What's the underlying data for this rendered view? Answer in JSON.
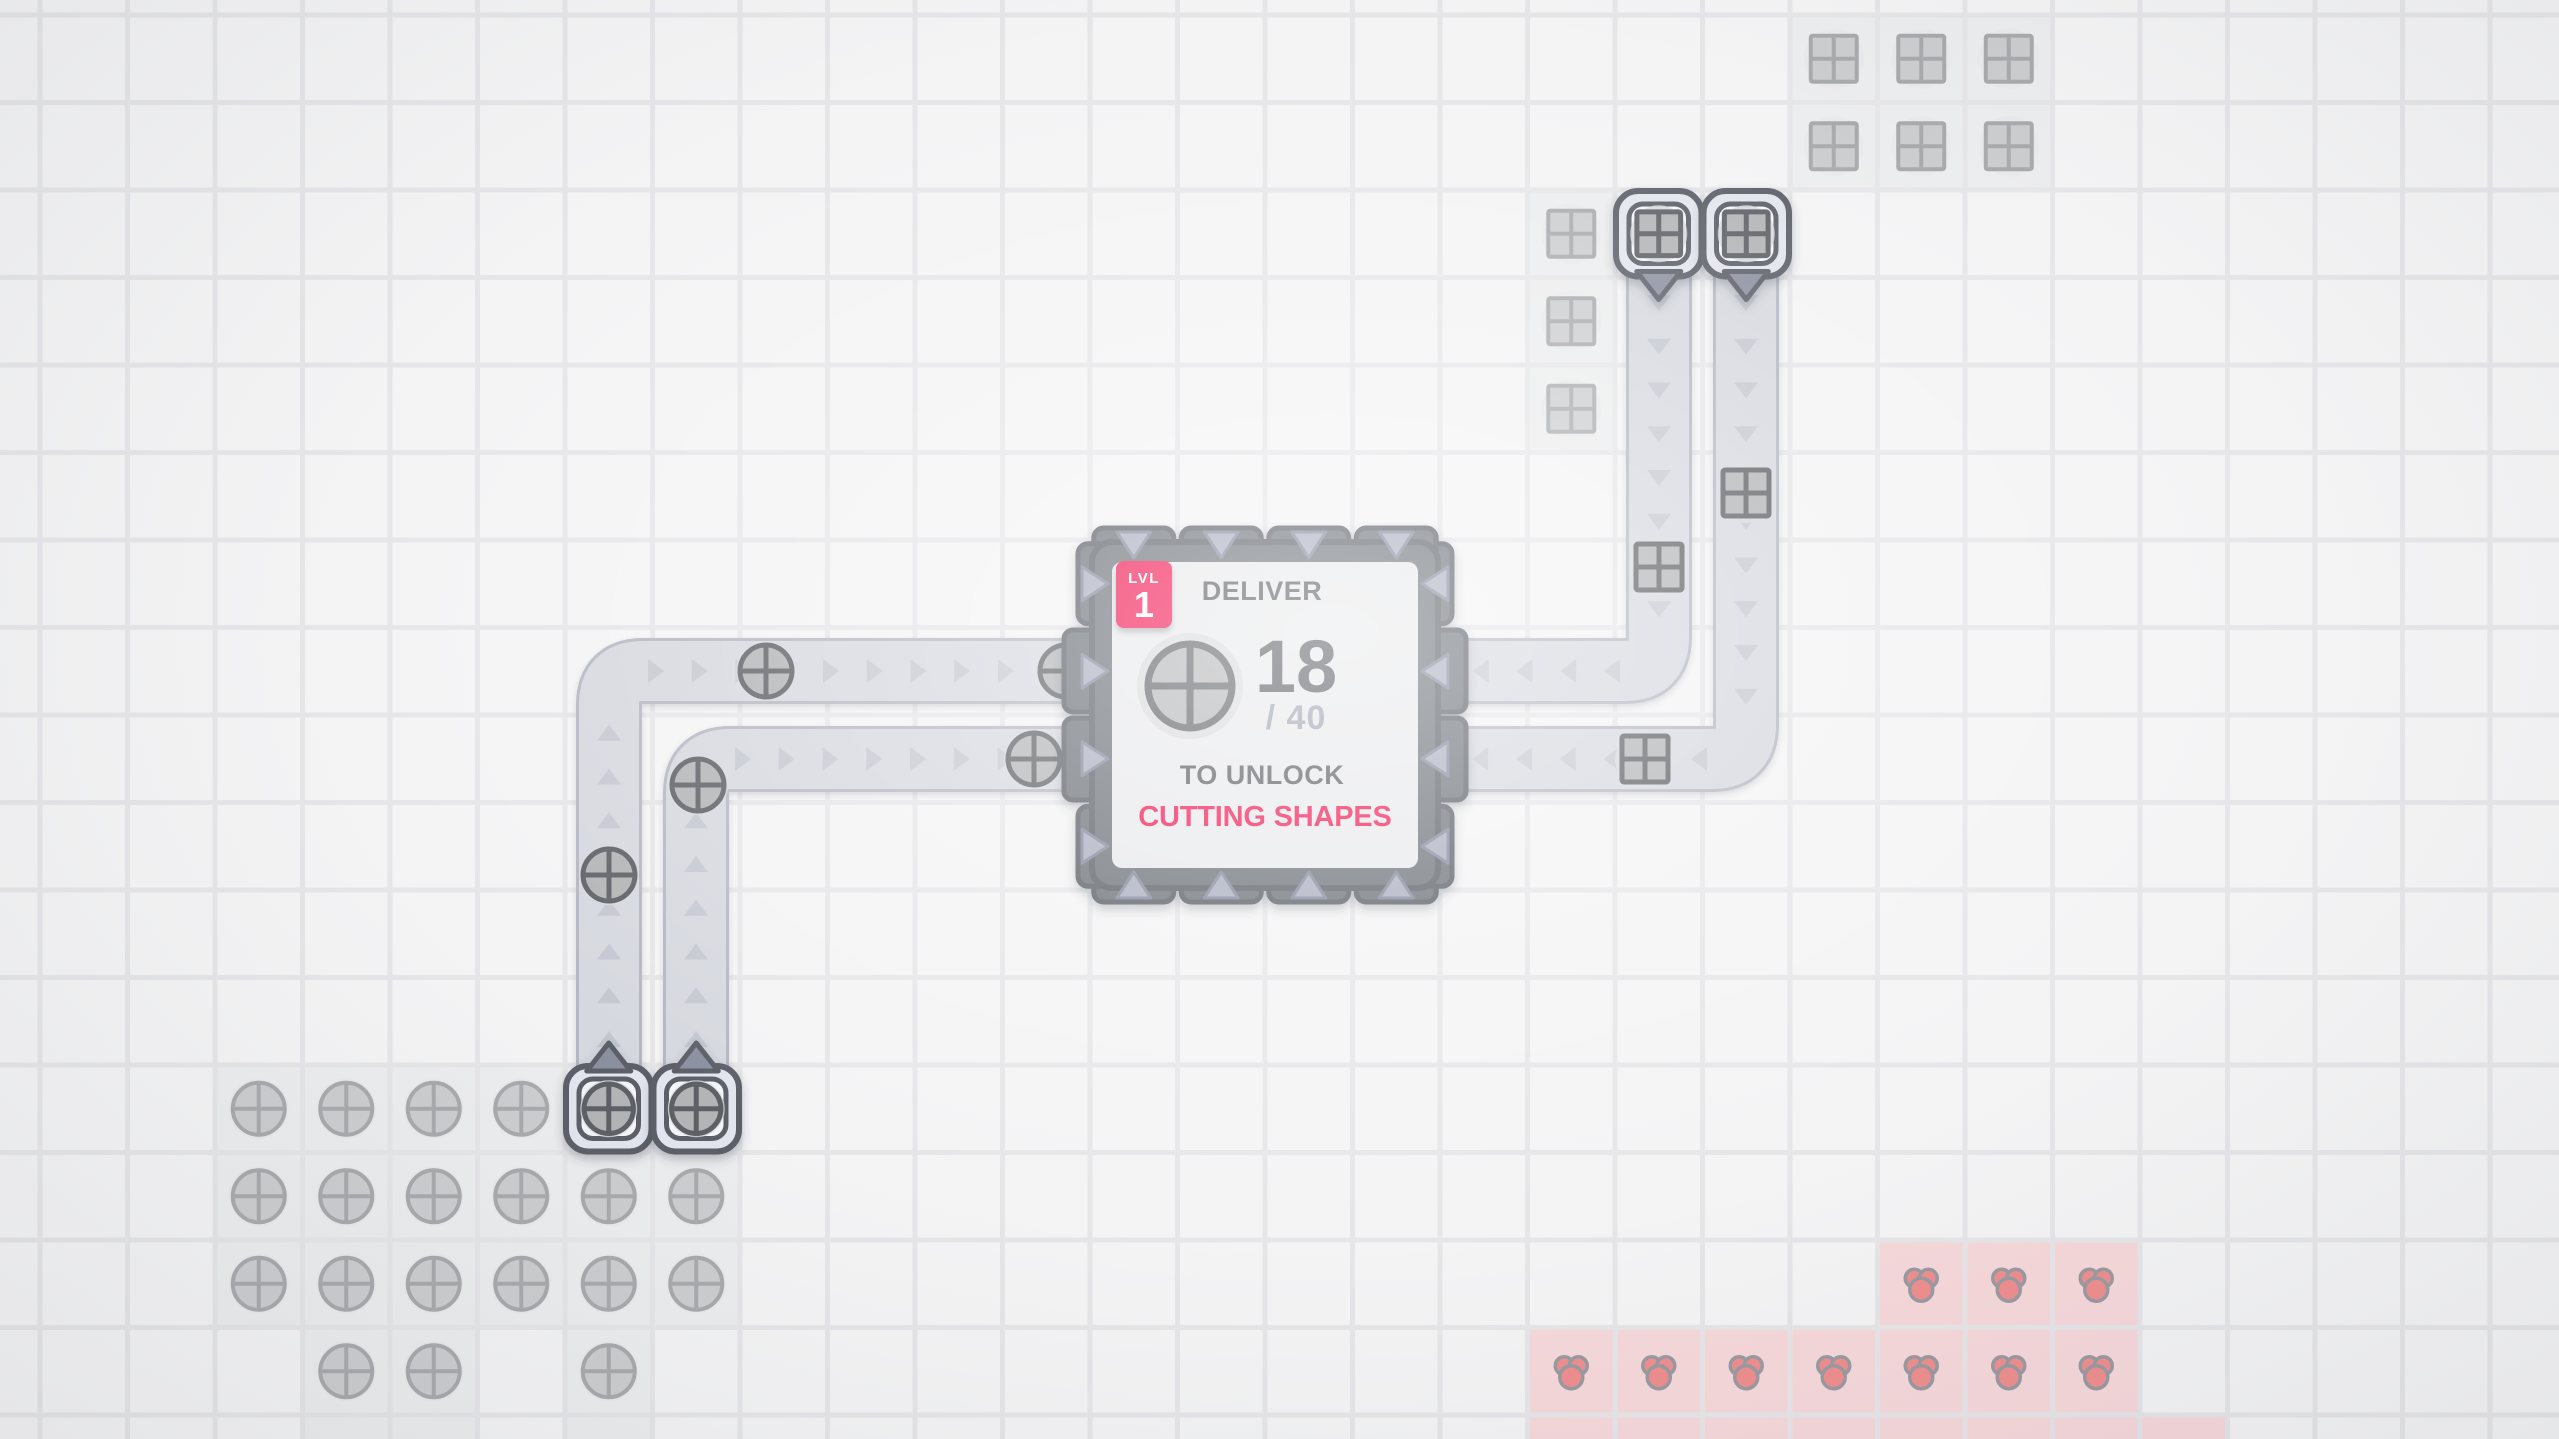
{
  "app": "shape-factory-game",
  "hub": {
    "col": 12,
    "row": 6,
    "span": 4,
    "badge": {
      "level_label": "LVL",
      "level": "1"
    },
    "deliver_label": "DELIVER",
    "delivered": "18",
    "goal_suffix": "/ 40",
    "unlock_label": "TO UNLOCK",
    "reward_label": "CUTTING SHAPES",
    "goal_shape": "circle"
  },
  "grid": {
    "tile": 87.5,
    "offset_x": 40,
    "offset_y": 15
  },
  "colors": {
    "accent": "#f2134f",
    "text_dark": "#55585e",
    "text_muted": "#9ca1ac",
    "belt": "#d6d8df",
    "belt_edge": "#b4b7c2",
    "chevron": "#c4c7d0",
    "hub_block": "#6b6f76",
    "hub_border": "#585c63",
    "hub_panel": "#e8e9eb",
    "notch": "#a8acbe",
    "notch_edge": "#81859a",
    "item_fill": "#b3b4b6",
    "item_stroke": "#5d6065",
    "item_halo": "#d8d9dc",
    "faded_fill": "#cccdcf",
    "faded_stroke": "#a8aaad",
    "faded_halo": "#e7e8ea",
    "red_fill": "#ef8e8e",
    "red_stroke": "#9a9aa2",
    "patch_gray": "#ecedee",
    "patch_red": "#f6d8da",
    "extractor_outer": "#e3e5ee",
    "extractor_inner": "#f4f5f8",
    "extractor_border": "#5b5f67",
    "arrow_fill": "#8b90a0"
  },
  "patches": [
    {
      "type": "circle",
      "tiles": [
        [
          2,
          12
        ],
        [
          3,
          12
        ],
        [
          4,
          12
        ],
        [
          5,
          12
        ],
        [
          6,
          12
        ],
        [
          7,
          12
        ],
        [
          2,
          13
        ],
        [
          3,
          13
        ],
        [
          4,
          13
        ],
        [
          5,
          13
        ],
        [
          6,
          13
        ],
        [
          7,
          13
        ],
        [
          2,
          14
        ],
        [
          3,
          14
        ],
        [
          4,
          14
        ],
        [
          5,
          14
        ],
        [
          6,
          14
        ],
        [
          7,
          14
        ],
        [
          3,
          15
        ],
        [
          4,
          15
        ],
        [
          6,
          15
        ],
        [
          3,
          16
        ],
        [
          4,
          16
        ],
        [
          6,
          16
        ]
      ],
      "resources": [
        [
          2,
          12
        ],
        [
          3,
          12
        ],
        [
          4,
          12
        ],
        [
          5,
          12
        ],
        [
          2,
          13
        ],
        [
          3,
          13
        ],
        [
          4,
          13
        ],
        [
          5,
          13
        ],
        [
          6,
          13
        ],
        [
          7,
          13
        ],
        [
          2,
          14
        ],
        [
          3,
          14
        ],
        [
          4,
          14
        ],
        [
          5,
          14
        ],
        [
          6,
          14
        ],
        [
          7,
          14
        ],
        [
          3,
          15
        ],
        [
          4,
          15
        ],
        [
          6,
          15
        ]
      ]
    },
    {
      "type": "square",
      "tiles": [
        [
          20,
          0
        ],
        [
          21,
          0
        ],
        [
          22,
          0
        ],
        [
          20,
          1
        ],
        [
          21,
          1
        ],
        [
          22,
          1
        ]
      ],
      "resources": [
        [
          20,
          0
        ],
        [
          21,
          0
        ],
        [
          22,
          0
        ],
        [
          20,
          1
        ],
        [
          21,
          1
        ],
        [
          22,
          1
        ]
      ]
    },
    {
      "type": "square",
      "tiles": [
        [
          17,
          2
        ],
        [
          17,
          3
        ],
        [
          17,
          4
        ]
      ],
      "resources": [
        [
          17,
          2
        ],
        [
          17,
          3
        ],
        [
          17,
          4
        ]
      ]
    },
    {
      "type": "red",
      "tiles": [
        [
          21,
          14
        ],
        [
          22,
          14
        ],
        [
          23,
          14
        ],
        [
          17,
          15
        ],
        [
          18,
          15
        ],
        [
          19,
          15
        ],
        [
          20,
          15
        ],
        [
          21,
          15
        ],
        [
          22,
          15
        ],
        [
          23,
          15
        ],
        [
          17,
          16
        ],
        [
          18,
          16
        ],
        [
          19,
          16
        ],
        [
          20,
          16
        ],
        [
          21,
          16
        ],
        [
          22,
          16
        ],
        [
          23,
          16
        ],
        [
          24,
          16
        ]
      ],
      "resources": [
        [
          21,
          14
        ],
        [
          22,
          14
        ],
        [
          23,
          14
        ],
        [
          17,
          15
        ],
        [
          18,
          15
        ],
        [
          19,
          15
        ],
        [
          20,
          15
        ],
        [
          21,
          15
        ],
        [
          22,
          15
        ],
        [
          23,
          15
        ]
      ]
    }
  ],
  "extractors": [
    {
      "col": 6,
      "row": 12,
      "out": "up",
      "shape": "circle"
    },
    {
      "col": 7,
      "row": 12,
      "out": "up",
      "shape": "circle"
    },
    {
      "col": 18,
      "row": 2,
      "out": "down",
      "shape": "square"
    },
    {
      "col": 19,
      "row": 2,
      "out": "down",
      "shape": "square"
    }
  ],
  "belts": [
    {
      "path": [
        [
          609,
          1066
        ],
        [
          609,
          671
        ],
        [
          1098,
          671
        ]
      ]
    },
    {
      "path": [
        [
          696,
          1066
        ],
        [
          696,
          759
        ],
        [
          1098,
          759
        ]
      ]
    },
    {
      "path": [
        [
          1659,
          276
        ],
        [
          1659,
          671
        ],
        [
          1427,
          671
        ]
      ]
    },
    {
      "path": [
        [
          1746,
          276
        ],
        [
          1746,
          759
        ],
        [
          1427,
          759
        ]
      ]
    }
  ],
  "belt_items": [
    {
      "shape": "circle",
      "x": 766,
      "y": 671
    },
    {
      "shape": "circle",
      "x": 1066,
      "y": 671
    },
    {
      "shape": "circle",
      "x": 609,
      "y": 875
    },
    {
      "shape": "circle",
      "x": 698,
      "y": 785
    },
    {
      "shape": "circle",
      "x": 1034,
      "y": 759
    },
    {
      "shape": "square",
      "x": 1659,
      "y": 567
    },
    {
      "shape": "square",
      "x": 1746,
      "y": 493
    },
    {
      "shape": "square",
      "x": 1645,
      "y": 759
    }
  ]
}
